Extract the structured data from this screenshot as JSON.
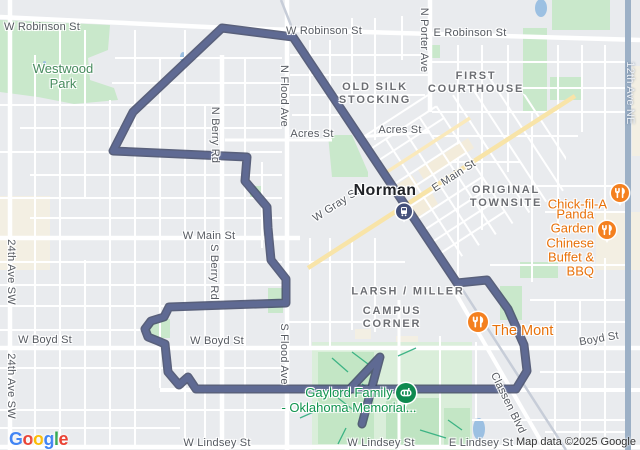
{
  "attribution": "Map data ©2025 Google",
  "google_logo": {
    "letters": [
      "G",
      "o",
      "o",
      "g",
      "l",
      "e"
    ]
  },
  "city": {
    "norman": "Norman"
  },
  "streets": {
    "w_robinson_west": "W Robinson St",
    "w_robinson_mid": "W Robinson St",
    "e_robinson": "E Robinson St",
    "n_porter_ave": "N Porter Ave",
    "ave_12th_ne": "12th Ave NE",
    "n_berry_rd": "N Berry Rd",
    "n_flood_ave": "N Flood Ave",
    "acres_st_west": "Acres St",
    "acres_st_east": "Acres St",
    "e_main_st": "E Main St",
    "w_gray_st": "W Gray St",
    "w_main_st": "W Main St",
    "s_berry_rd": "S Berry Rd",
    "ave_24th_sw_north": "24th Ave SW",
    "ave_24th_sw_south": "24th Ave SW",
    "w_boyd_west": "W Boyd St",
    "w_boyd_mid": "W Boyd St",
    "boyd_east": "Boyd St",
    "s_flood_ave": "S Flood Ave",
    "classen_blvd": "Classen Blvd",
    "w_lindsey_west": "W Lindsey St",
    "w_lindsey_mid": "W Lindsey St",
    "e_lindsey": "E Lindsey St"
  },
  "areas": {
    "old_silk_stocking": "OLD SILK\nSTOCKING",
    "first_courthouse": "FIRST\nCOURTHOUSE",
    "original_townsite": "ORIGINAL\nTOWNSITE",
    "larsh_miller": "LARSH / MILLER",
    "campus_corner": "CAMPUS\nCORNER"
  },
  "parks": {
    "westwood": "Westwood\nPark",
    "gaylord_memorial": "Gaylord Family\n- Oklahoma Memorial..."
  },
  "pois": {
    "chick_fil_a": "Chick-fil-A",
    "panda_garden": "Panda Garden Chinese\nBuffet & BBQ",
    "the_mont": "The Mont"
  },
  "icons": {
    "restaurant_pin": "fork-knife-icon",
    "stadium_pin": "stadium-icon",
    "transit_station": "train-icon"
  },
  "palette": {
    "map_bg": "#e9ebee",
    "road_white": "#ffffff",
    "road_yellow": "#f8e4a8",
    "road_blue": "#9cb0c6",
    "railroad_gray": "#c7cdd8",
    "park_green": "#c9e8cb",
    "campus_green": "#daeeda",
    "commercial_beige": "#f3ecdb",
    "water_blue": "#9cc0e2",
    "path_teal": "#2fae7e",
    "route_fill": "#5f6a93",
    "route_outline": "#3f4866",
    "poi_orange": "#e8710a",
    "park_text_green": "#478b5e",
    "stadium_pin_green": "#0e8a4f",
    "transit_navy": "#44507a"
  }
}
